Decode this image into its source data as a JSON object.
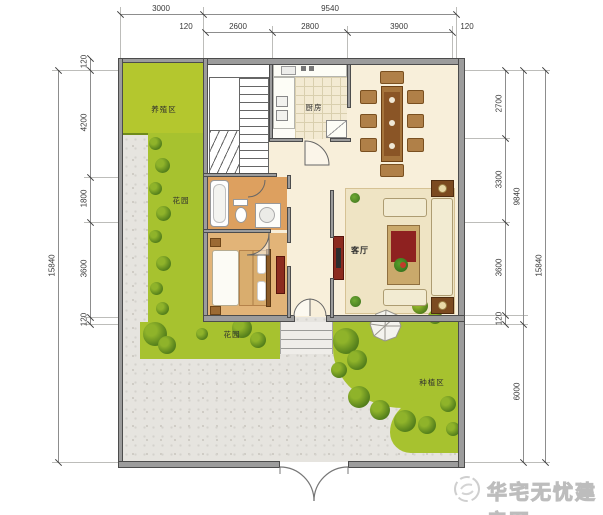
{
  "plan": {
    "rooms": {
      "kitchen_label": "厨房",
      "living_label": "客厅",
      "garden_strip_label": "花园",
      "front_garden_label": "花园",
      "breeding_label": "养殖区",
      "planting_label": "种植区"
    },
    "dimensions": {
      "top_row1": [
        "3000",
        "9540"
      ],
      "top_row2": [
        "120",
        "2600",
        "2800",
        "3900",
        "120"
      ],
      "left_inner": [
        "120",
        "4200",
        "1800",
        "3600",
        "120"
      ],
      "left_total": "15840",
      "right_inner": [
        "2700",
        "3300",
        "3600",
        "120"
      ],
      "right_mid": [
        "9840",
        "6000"
      ],
      "right_total": "15840"
    }
  },
  "watermark": {
    "site_name": "华宅无忧建房网"
  },
  "colors": {
    "grass": "#a7c22f",
    "wall_gray": "#9c9c9c",
    "courtyard_gray": "#e6e4df",
    "wood_floor": "#e2b478",
    "bath_floor": "#dda05f",
    "cream_floor": "#f8efda",
    "accent_red": "#8c2b1f",
    "watermark_gray": "#c9c9c9"
  }
}
